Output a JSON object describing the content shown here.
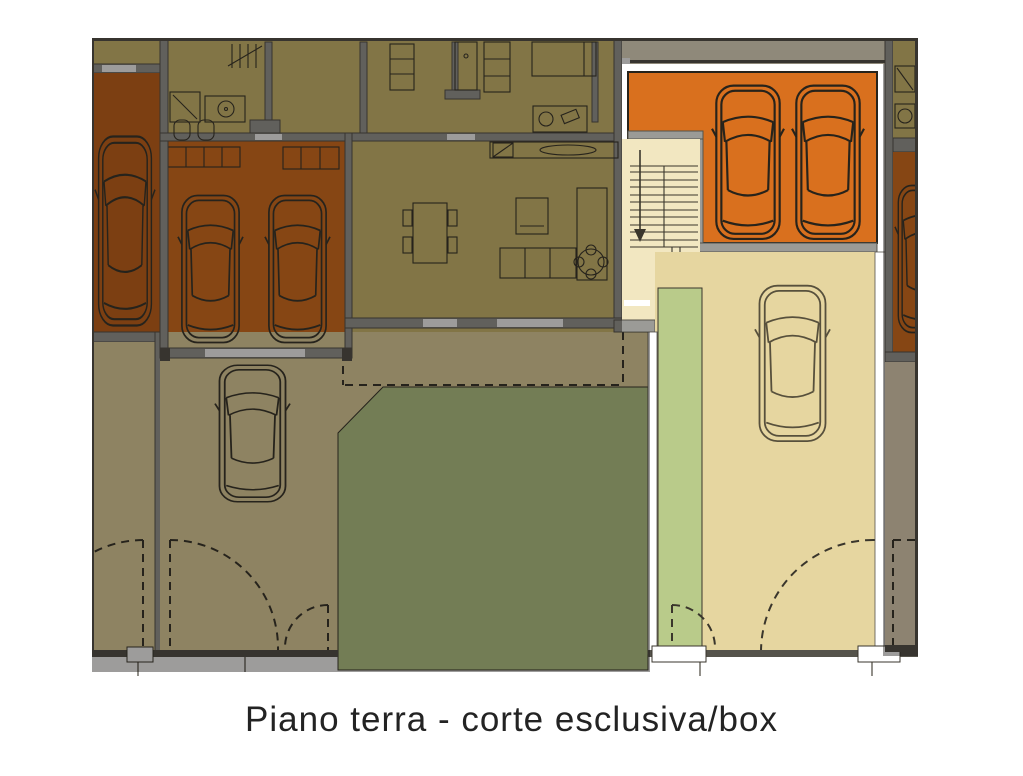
{
  "caption": "Piano terra - corte esclusiva/box",
  "plan": {
    "highlighted_unit_regions": [
      "box-garage",
      "stair-hall",
      "exclusive-courtyard",
      "green-strip"
    ],
    "dimmed_context_regions": [
      "left-neighbor-garage",
      "left-unit-interior",
      "left-unit-garage",
      "left-courtyard",
      "garden",
      "right-neighbor-unit",
      "right-neighbor-courtyard"
    ],
    "car_count_total": 7
  },
  "colors": {
    "page_bg": "#ffffff",
    "line": "#3a362c",
    "line_strong": "#27231b",
    "wall": "#9b9b97",
    "wall_dark": "#55534b",
    "interior": "#d2be72",
    "garage_orange": "#d9701e",
    "garage_left": "#c8651c",
    "courtyard": "#e6d6a0",
    "stair": "#f2e7c1",
    "garden": "#b9cb8a",
    "band": "#e8e0c8",
    "neighbor_court": "#e4d6ba",
    "white": "#ffffff",
    "car_light": "#57503c",
    "dim": "rgba(10,8,4,0.40)",
    "caption_text": "#232323"
  }
}
